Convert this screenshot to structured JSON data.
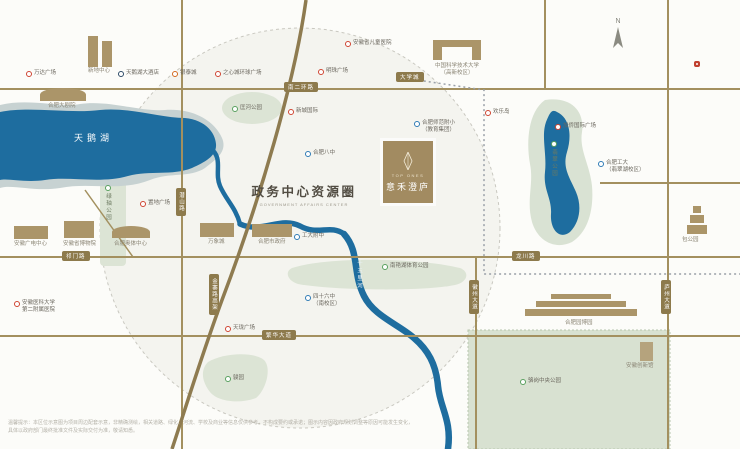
{
  "title": {
    "zh": "政务中心资源圈",
    "en": "GOVERNMENT AFFAIRS CENTER"
  },
  "logo": {
    "latin": "TOP ONES",
    "name": "意禾澄庐"
  },
  "compass": "N",
  "water": {
    "swan_lake": "天鹅湖",
    "shiwuli_river": "十五里河"
  },
  "roads": {
    "nanerhuan": "南二环路",
    "qimen": "祁门路",
    "fanhua": "繁华大道",
    "longchuan": "龙川路",
    "qianshan": "潜山路",
    "jinzhai_viaduct": "金寨路高架",
    "huizhou_ave": "徽州大道",
    "luzhou_ave": "庐州大道",
    "daxuecheng": "大学城"
  },
  "pois": {
    "wanda": "万达广场",
    "xindi": "新地中心",
    "swan_hotel": "天鹅湖大酒店",
    "yintai": "银泰城",
    "zhixin": "之心城环球广场",
    "mingzhu": "明珠广场",
    "children_hospital": "安徽省儿童医院",
    "ustc_l1": "中国科学技术大学",
    "ustc_l2": "（高新校区）",
    "kuanghe_park": "匡河公园",
    "xincheng": "新城国际",
    "hefei_no8": "合肥八中",
    "zhidi": "置地广场",
    "theater": "合肥大剧院",
    "lvzhou_park": "绿轴公园",
    "tv_center": "安徽广电中心",
    "museum": "安徽省博物院",
    "olympic": "合肥奥体中心",
    "mixc": "万象城",
    "city_gov": "合肥市政府",
    "gongda_fz": "工大附中",
    "shifan_l1": "合肥师范附小",
    "shifan_l2": "（教育集团）",
    "huanledao": "欢乐岛",
    "jiaqiao": "加侨国际广场",
    "feicui_park": "翡翠公园",
    "hfut_l1": "合肥工大",
    "hfut_l2": "（翡翠湖校区）",
    "nanyanhu": "南艳湖体育公园",
    "no46_l1": "四十六中",
    "no46_l2": "（南校区）",
    "tianlong": "天珑广场",
    "junyuan": "骏园",
    "anyida_l1": "安徽医科大学",
    "anyida_l2": "第二附属医院",
    "luogang_park": "骆岗中央公园",
    "yuanboyuan": "合肥园博园",
    "innovation_hall": "安徽创新馆",
    "baogongyuan": "包公园"
  },
  "disclaimer": {
    "line1": "温馨提示：本区位示意图为项目周边配套示意，非精确测绘，相关道路、绿化、河流、学校及商业等信息仅供参考，不构成要约或承诺；图示内容因政府规划调整等原因可能发生变化，",
    "line2": "具体以政府部门最终批准文件及实际交付为准，敬请知悉。"
  },
  "colors": {
    "road": "#A3905F",
    "water": "#1E6D9F",
    "park": "#DCE4D5",
    "brand": "#A28B61",
    "poi_red": "#CF4431",
    "poi_blue": "#2E7BB5",
    "poi_green": "#58A05E"
  }
}
